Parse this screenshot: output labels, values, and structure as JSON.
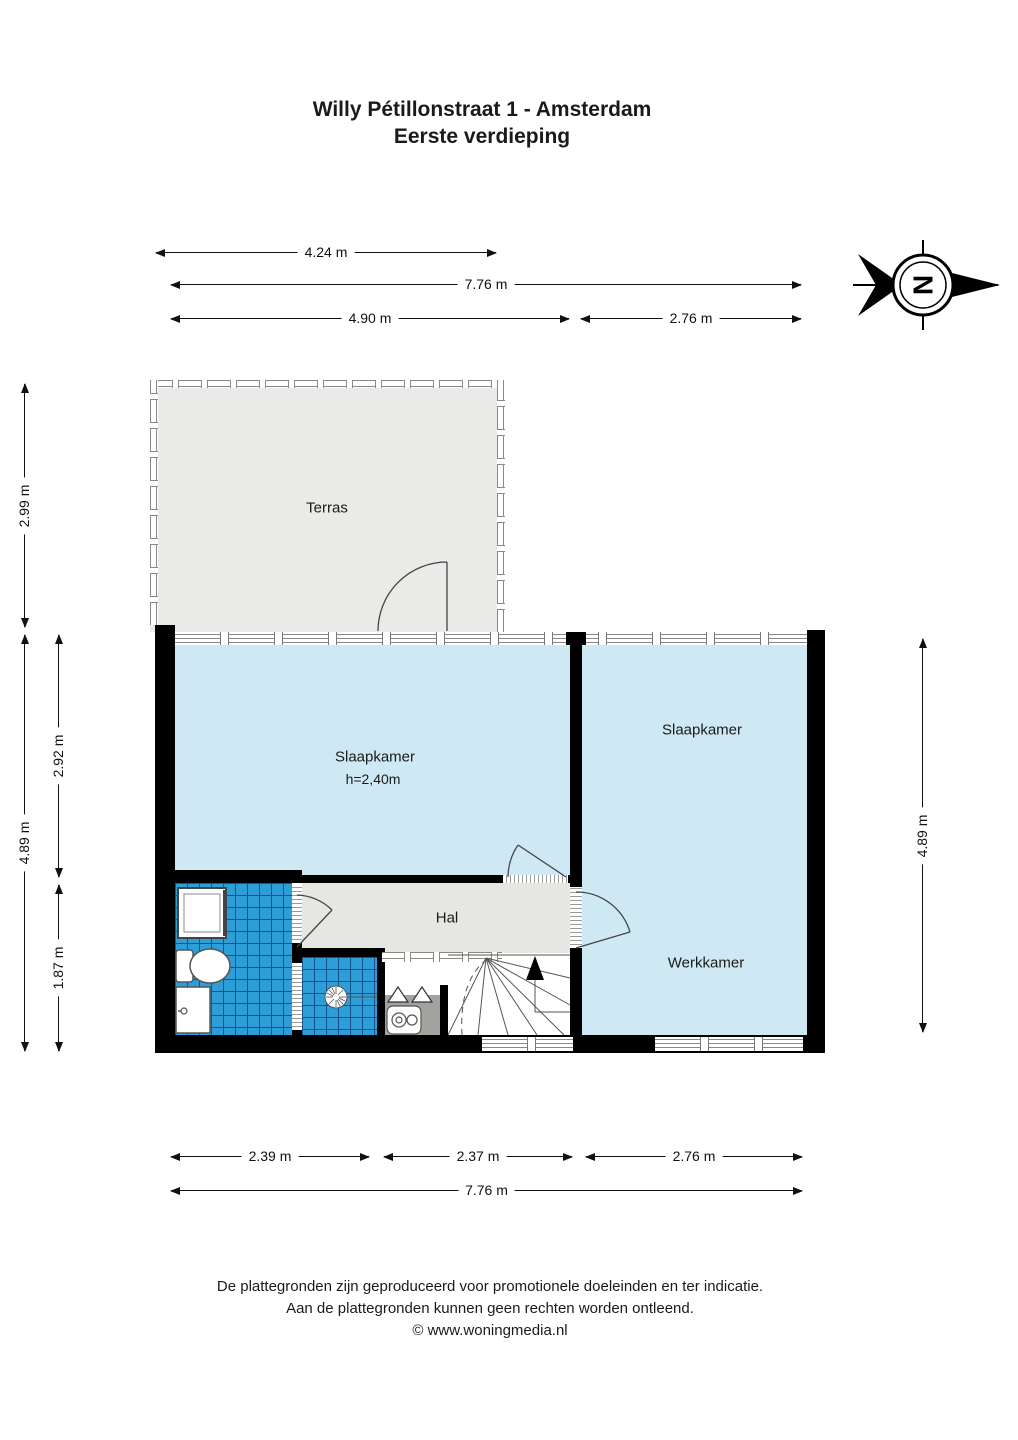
{
  "title": {
    "line1": "Willy Pétillonstraat 1 - Amsterdam",
    "line2": "Eerste verdieping"
  },
  "compass": {
    "north_letter": "N"
  },
  "rooms": {
    "terras": "Terras",
    "slaapkamer_left": "Slaapkamer",
    "slaapkamer_left_ceiling": "h=2,40m",
    "slaapkamer_right": "Slaapkamer",
    "hal": "Hal",
    "werkkamer": "Werkkamer"
  },
  "dimensions": {
    "top_terras_width": "4.24 m",
    "top_total_width": "7.76 m",
    "top_left_width": "4.90 m",
    "top_right_width": "2.76 m",
    "left_terras_depth": "2.99 m",
    "left_total_depth": "4.89 m",
    "left_bedroom_depth": "2.92 m",
    "left_bathroom_depth": "1.87 m",
    "right_total_depth": "4.89 m",
    "bottom_left_width": "2.39 m",
    "bottom_middle_width": "2.37 m",
    "bottom_right_width": "2.76 m",
    "bottom_total_width": "7.76 m"
  },
  "footer": {
    "line1": "De plattegronden zijn geproduceerd voor promotionele doeleinden en ter indicatie.",
    "line2": "Aan de plattegronden kunnen geen rechten worden ontleend.",
    "line3": "© www.woningmedia.nl"
  },
  "colors": {
    "wall": "#000000",
    "room_fill": "#cfe9f4",
    "tile_fill": "#2d9ed8",
    "tile_grid": "#15548c",
    "hall_fill": "#e6e6e2",
    "terrace_fill": "#eaeae8"
  }
}
